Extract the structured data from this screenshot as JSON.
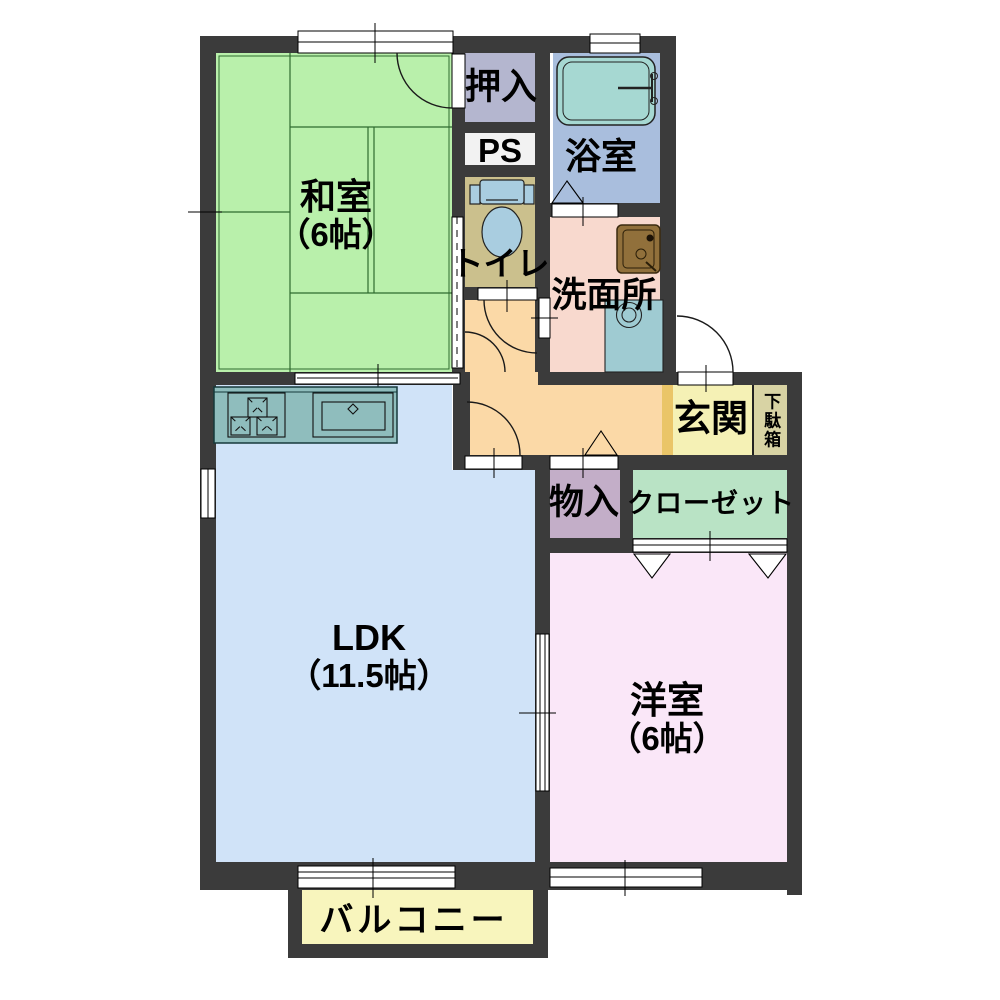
{
  "plan_title": "apartment-floor-plan",
  "palette": {
    "wall": "#3b3b3b",
    "background": "#ffffff",
    "tatami_line": "#2f6b2f",
    "counter": "#8fbdbd",
    "bathtub": "#a6d8d2",
    "toilet_fixture": "#a9cde0",
    "washer_pan": "#9fcbd2",
    "vanity_sink": "#91703b"
  },
  "rooms": {
    "washitsu": {
      "label": "和室",
      "size_label": "（6帖）",
      "color": "#b9f0ab"
    },
    "oshiire": {
      "label": "押入",
      "color": "#b4b6cf"
    },
    "ps": {
      "label": "PS",
      "color": "#f2f2f2"
    },
    "toilet": {
      "label": "トイレ",
      "color": "#cbc08d"
    },
    "bathroom": {
      "label": "浴室",
      "color": "#a9bedd"
    },
    "washroom": {
      "label": "洗面所",
      "color": "#f8d9ce"
    },
    "hallway": {
      "color": "#fbd9a7"
    },
    "agarikamachi": {
      "color": "#eac568"
    },
    "genkan": {
      "label": "玄関",
      "color": "#f5f1b5"
    },
    "getabako": {
      "label": "下駄箱",
      "color": "#d8d3a4"
    },
    "mono_ire": {
      "label": "物入",
      "color": "#c3aec8"
    },
    "closet": {
      "label": "クローゼット",
      "color": "#b9e3c5"
    },
    "ldk": {
      "label": "LDK",
      "size_label": "（11.5帖）",
      "color": "#d0e3f8"
    },
    "youshitsu": {
      "label": "洋室",
      "size_label": "（6帖）",
      "color": "#fae7f8"
    },
    "balcony": {
      "label": "バルコニー",
      "color": "#f8f5bd"
    }
  },
  "fixtures": [
    "bathtub-icon",
    "toilet-icon",
    "vanity-sink-icon",
    "washer-pan-icon",
    "stove-icon",
    "kitchen-sink-icon",
    "kitchen-counter"
  ]
}
